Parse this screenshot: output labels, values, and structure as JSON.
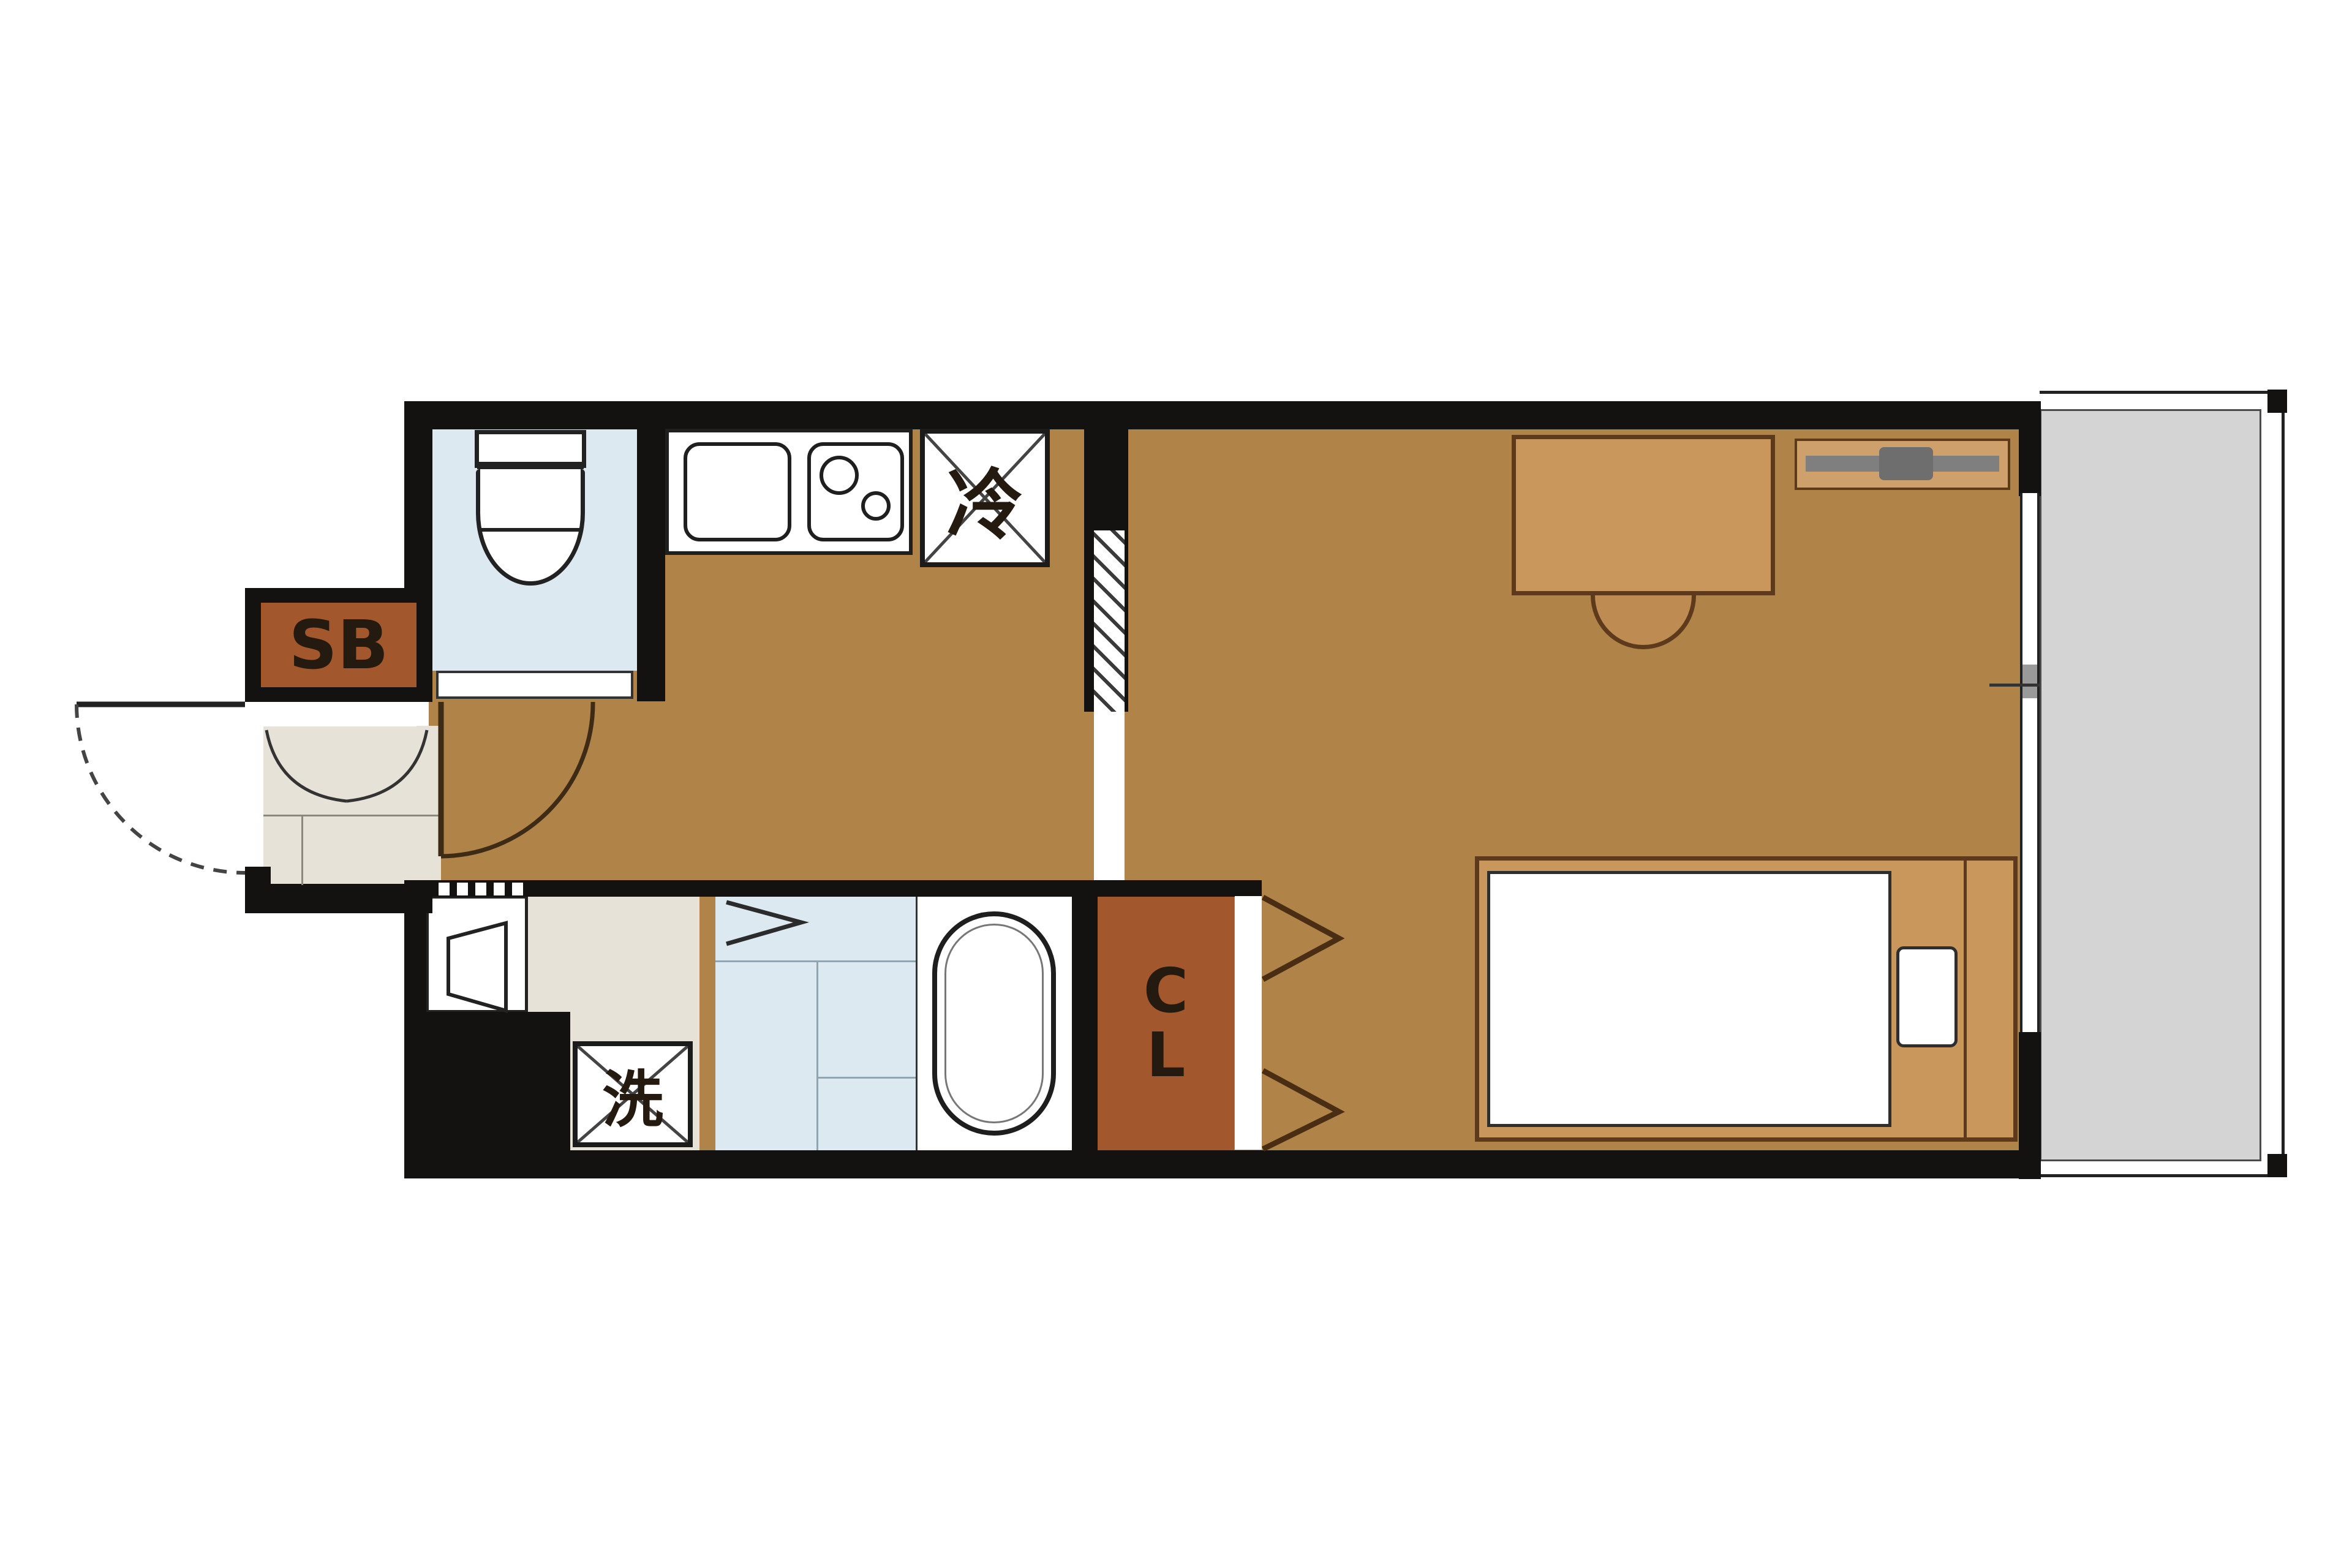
{
  "floorplan": {
    "labels": {
      "shoe_box": "SB",
      "refrigerator": "冷",
      "washing_machine": "洗",
      "closet_line1": "C",
      "closet_line2": "L"
    },
    "colors": {
      "wall": "#141210",
      "wood_floor": "#B08348",
      "storage_rust": "#A2572C",
      "wet_area_blue": "#DCE9F0",
      "entrance_beige": "#E7E2D8",
      "balcony_gray": "#D4D4D4",
      "furniture_tan": "#C9965C",
      "tv_gray": "#7F7F7F"
    }
  }
}
